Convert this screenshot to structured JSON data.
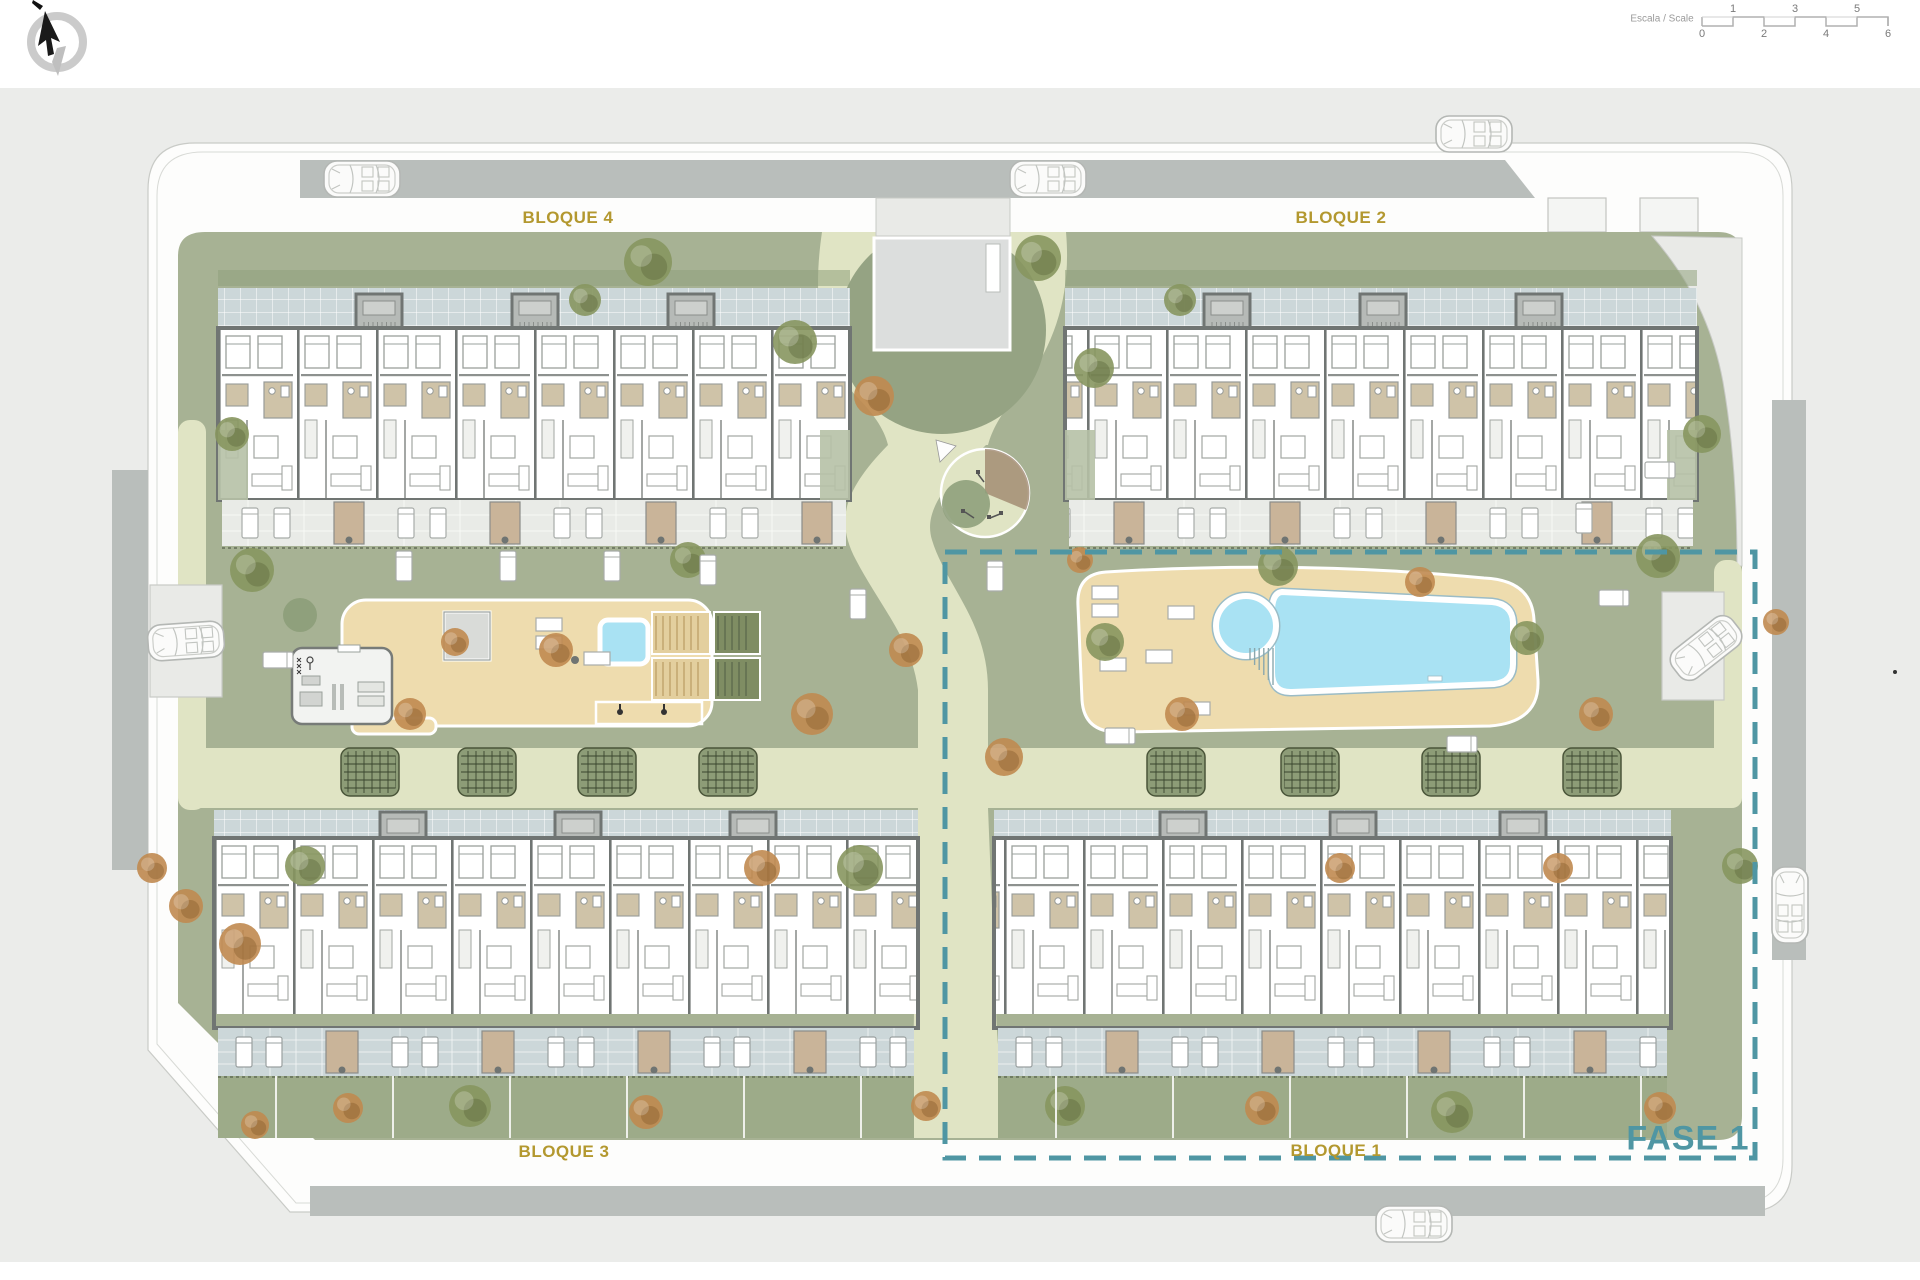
{
  "plan": {
    "type": "residential-site-plan",
    "phase_label": "FASE 1",
    "blocks": [
      {
        "label": "BLOQUE 4",
        "position": "top-left"
      },
      {
        "label": "BLOQUE 2",
        "position": "top-right"
      },
      {
        "label": "BLOQUE 3",
        "position": "bottom-left"
      },
      {
        "label": "BLOQUE 1",
        "position": "bottom-right"
      }
    ]
  },
  "labels": {
    "bloque_4": "BLOQUE 4",
    "bloque_2": "BLOQUE 2",
    "bloque_3": "BLOQUE 3",
    "bloque_1": "BLOQUE 1",
    "fase_1": "FASE 1"
  },
  "scale_bar": {
    "label": "Escala / Scale",
    "top_ticks": [
      "1",
      "3",
      "5"
    ],
    "bottom_ticks": [
      "0",
      "2",
      "4",
      "6"
    ]
  },
  "icons": {
    "compass": "north-arrow-compass-icon",
    "scale_bar": "graphic-scale-bar",
    "pool": "swimming-pool",
    "playground": "playground-circle"
  },
  "colors": {
    "paved": "#ebecea",
    "road": "#b9bebb",
    "garden": "#a7b294",
    "garden_dark": "#95a383",
    "path": "#e0e4c4",
    "tile": "#ccd7d9",
    "tile_light": "#e9ebe7",
    "wall": "#707573",
    "bath": "#cfc3a8",
    "deck": "#eedcae",
    "pool": "#a9e2f3",
    "planter": "#c9b499",
    "strip_green": "#9dab89",
    "bed_green": "#8d9c77",
    "gold": "#b3982f",
    "teal": "#4f96a3",
    "tree_green": "#87965f",
    "tree_rust": "#c08a50"
  }
}
